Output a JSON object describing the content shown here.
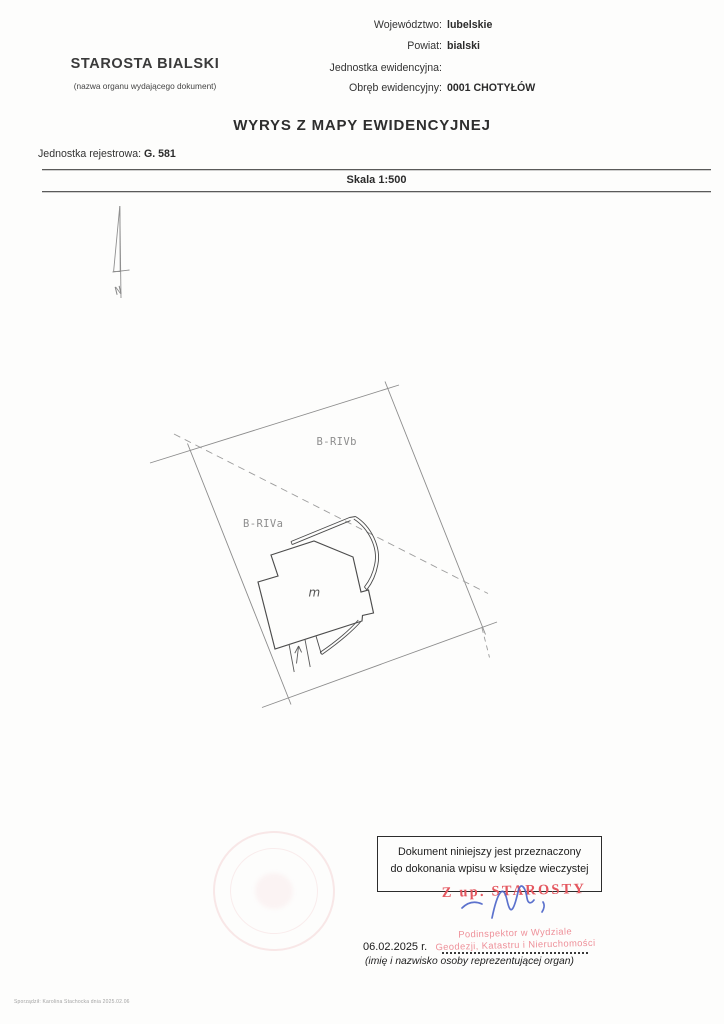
{
  "header": {
    "org_name": "STAROSTA BIALSKI",
    "org_caption": "(nazwa organu wydającego dokument)",
    "info": [
      {
        "label": "Województwo:",
        "value": "lubelskie"
      },
      {
        "label": "Powiat:",
        "value": "bialski"
      },
      {
        "label": "Jednostka ewidencyjna:",
        "value": ""
      },
      {
        "label": "Obręb ewidencyjny:",
        "value": "0001 CHOTYŁÓW"
      }
    ]
  },
  "title": "WYRYS Z MAPY EWIDENCYJNEJ",
  "registry": {
    "label": "Jednostka rejestrowa:",
    "value": "G. 581"
  },
  "scale": "Skala 1:500",
  "map": {
    "north_label": "N",
    "labels": {
      "parcel_upper": "B-RIVb",
      "parcel_lower": "B-RIVa",
      "building": "m"
    }
  },
  "notice_box": {
    "line1": "Dokument niniejszy jest przeznaczony",
    "line2": "do dokonania wpisu w księdze wieczystej"
  },
  "stamp": {
    "authorization": "Z up. STAROSTY",
    "position_line1": "Podinspektor w Wydziale",
    "position_line2": "Geodezji, Katastru i Nieruchomości",
    "color": "#e4575f"
  },
  "signature": {
    "ink_color": "#4b63c8"
  },
  "signature_date": {
    "date": "06.02.2025 r.",
    "caption": "(imię i nazwisko osoby reprezentującej organ)"
  },
  "footer": {
    "prepared_by": "Sporządził: Karolina Stachocka dnia 2025.02.06"
  }
}
